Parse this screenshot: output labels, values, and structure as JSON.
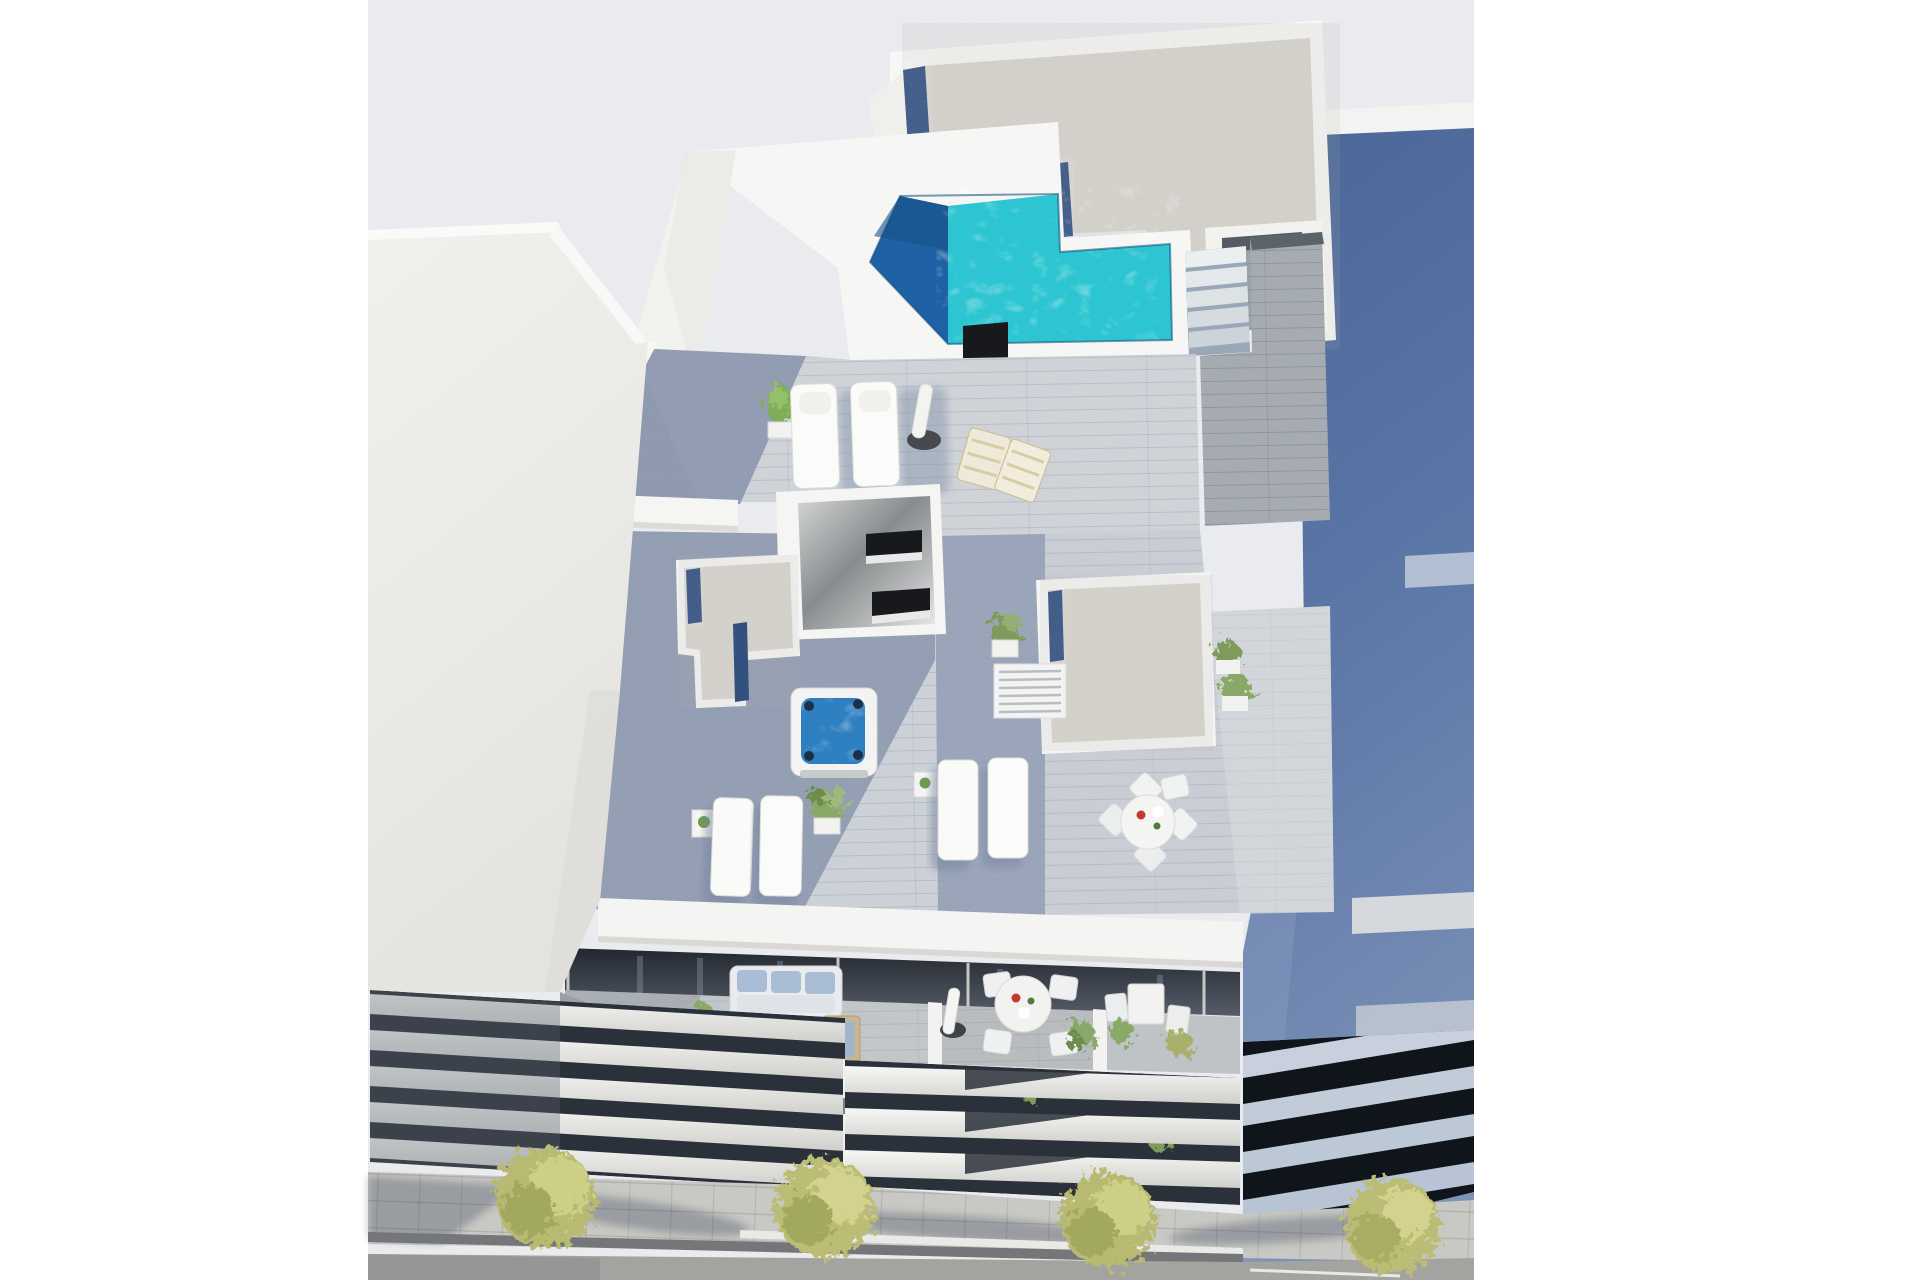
{
  "meta": {
    "type": "architectural-3d-render",
    "title": "Aerial render of a modern white residential building",
    "description": "Top-down 3D architectural visualization of a new-build white apartment block with rooftop terraces, an L-shaped turquoise pool with deep blue end, jacuzzi, gravel roofs with navy drainage strips, sun loungers, dining sets, front balconies with outdoor furniture, louvred facade bands, a paved sidewalk with four olive-green trees and an asphalt street, flanked by a white building on the left and a blue-shadowed building on the right."
  },
  "palette": {
    "page_background": "#ffffff",
    "sky": "#e9ebee",
    "white_walls": "#f5f5f3",
    "gravel_roof": "#d9d6d0",
    "gravel_blue_strip": "#33517f",
    "pool_turquoise": "#2cc5d1",
    "pool_deep_blue": "#1e62a5",
    "jacuzzi_water": "#2e7fc0",
    "deck_shadow": "#8793ab",
    "deck_sunlit": "#d2d5da",
    "wood_walkway": "#a6abb2",
    "dark_opening": "#1a1d20",
    "balcony_interior": "#3c424c",
    "neighbour_right_shadow": "#5a76a6",
    "louver_gap": "#2b313a",
    "sidewalk": "#c8c8c4",
    "road": "#a3a3a0",
    "tree_foliage": "#bcbd74",
    "sofa_cushion": "#a9bdd4",
    "vent_black": "#17191c"
  },
  "objects": [
    {
      "name": "sky",
      "label": "Light grey sky backdrop"
    },
    {
      "name": "left-building",
      "label": "White neighbouring building with louvred balcony slats"
    },
    {
      "name": "right-building",
      "label": "Neighbouring building in blue shadow with slab balconies"
    },
    {
      "name": "gravel-roof",
      "label": "Gravel covered flat roof with navy drainage strips"
    },
    {
      "name": "pool",
      "label": "L-shaped rooftop swimming pool, turquoise with deep blue end"
    },
    {
      "name": "pool-stairs",
      "label": "Steps beside the pool"
    },
    {
      "name": "vent-chimney",
      "label": "Black rooftop vent chimney"
    },
    {
      "name": "penthouse-skylight",
      "label": "Glossy stairwell box with dark slot windows"
    },
    {
      "name": "jacuzzi",
      "label": "Square hot tub with blue water"
    },
    {
      "name": "planters",
      "label": "White planter walls topped with gravel and navy strips"
    },
    {
      "name": "sun-loungers",
      "label": "White padded sun loungers on wooden decks"
    },
    {
      "name": "deck-chairs",
      "label": "Timber folding deck chairs"
    },
    {
      "name": "parasol",
      "label": "Closed white parasol with dark base"
    },
    {
      "name": "dining-set-roof",
      "label": "Round white dining table with four chairs"
    },
    {
      "name": "balcony-sofa",
      "label": "Pale blue outdoor sofa with coffee tables and daybed"
    },
    {
      "name": "balcony-dining",
      "label": "Round balcony dining table with four chairs and closed parasol"
    },
    {
      "name": "balcony-bistro",
      "label": "Small bistro table with two chairs"
    },
    {
      "name": "potted-plants",
      "label": "Green potted shrubs"
    },
    {
      "name": "louver-facade",
      "label": "White horizontal louver bands of the facade"
    },
    {
      "name": "sidewalk",
      "label": "Paved sidewalk with four street trees casting long shadows"
    },
    {
      "name": "road",
      "label": "Asphalt street with white curb line"
    }
  ]
}
